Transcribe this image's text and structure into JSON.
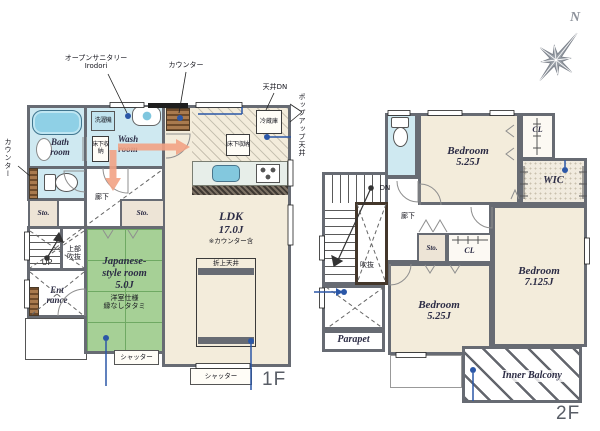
{
  "compass": {
    "north": "N"
  },
  "floor1": {
    "label": "1F",
    "ann": {
      "open_sanitary1": "オープンサニタリー",
      "open_sanitary2": "Irodori",
      "counter_top": "カウンター",
      "ceiling_dn": "天井DN",
      "popup_ceiling": "ポップアップ天井",
      "counter_left": "カウンター",
      "shutter1": "シャッター",
      "shutter2": "シャッター"
    },
    "bath": {
      "l1": "Bath",
      "l2": "room"
    },
    "wash": {
      "l1": "Wash",
      "l2": "room"
    },
    "washer": "洗濯機",
    "underfloor_wash": "床下収納",
    "underfloor_kitchen": "床下収納",
    "fridge": "冷蔵庫",
    "hallway": "廊下",
    "sto_left": "Sto.",
    "sto_mid": "Sto.",
    "up": "UP",
    "upper_void1": "上部",
    "upper_void2": "吹抜",
    "entrance1": "Ent",
    "entrance2": "rance",
    "jroom": {
      "l1": "Japanese-",
      "l2": "style room",
      "size": "5.0J",
      "n1": "洋室仕様",
      "n2": "縁なしタタミ"
    },
    "ldk": {
      "name": "LDK",
      "size": "17.0J",
      "note": "※カウンター含"
    },
    "oriage": "折上天井"
  },
  "floor2": {
    "label": "2F",
    "dn": "DN",
    "hallway": "廊下",
    "void": "吹抜",
    "sto": "Sto.",
    "cl_top": "CL",
    "cl_mid": "CL",
    "wic": "WIC",
    "bed_top": {
      "name": "Bedroom",
      "size": "5.25J"
    },
    "bed_bottom": {
      "name": "Bedroom",
      "size": "5.25J"
    },
    "bed_right": {
      "name": "Bedroom",
      "size": "7.125J"
    },
    "parapet": "Parapet",
    "balcony": "Inner Balcony"
  },
  "colors": {
    "wall": "#676b73",
    "water_blue": "#cfe9f1",
    "floor_cream": "#f3ecdb",
    "tatami_green": "#a6d096",
    "storage_beige": "#ede4d6",
    "counter_wood": "#a97a4e",
    "arrow_orange": "#f2a385",
    "accent_blue": "#2b57a7",
    "compass_gray": "#9aa0a8"
  }
}
